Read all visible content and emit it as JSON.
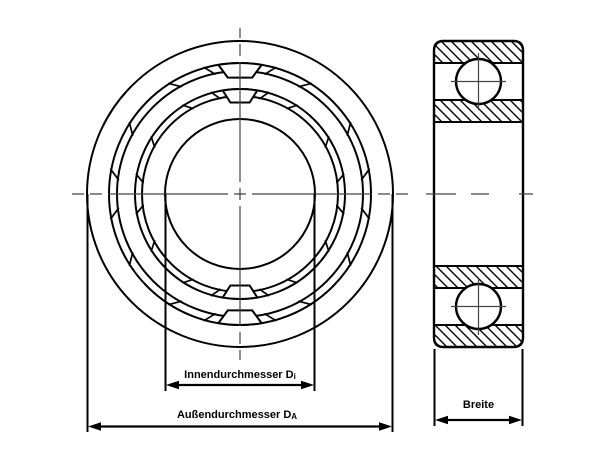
{
  "drawing": {
    "type": "technical-drawing-ball-bearing",
    "background": "#ffffff",
    "line_color": "#000000",
    "centerline_color": "#444444",
    "front_view": {
      "center_x": 240,
      "center_y": 194,
      "radii": [
        153,
        131,
        123,
        105,
        98,
        75
      ],
      "cage_bands": [
        [
          131,
          123
        ],
        [
          105,
          98
        ]
      ],
      "pocket_angles": [
        0,
        180
      ],
      "divider_angles": [
        16,
        33,
        57,
        79,
        101,
        123,
        147,
        164,
        196,
        213,
        237,
        259,
        281,
        303,
        327,
        344
      ]
    },
    "side_view": {
      "left": 434,
      "top": 41,
      "width": 89,
      "height": 306,
      "ball_radius": 22.5,
      "ball_centers_y": [
        81.5,
        306.5
      ],
      "outer_band_thickness": 22,
      "inner_band_thickness": 22
    },
    "dimensions": {
      "inner_diameter": {
        "label": "Innendurchmesser D",
        "subscript": "i"
      },
      "outer_diameter": {
        "label": "Außendurchmesser D",
        "subscript": "A"
      },
      "width": {
        "label": "Breite"
      }
    }
  }
}
